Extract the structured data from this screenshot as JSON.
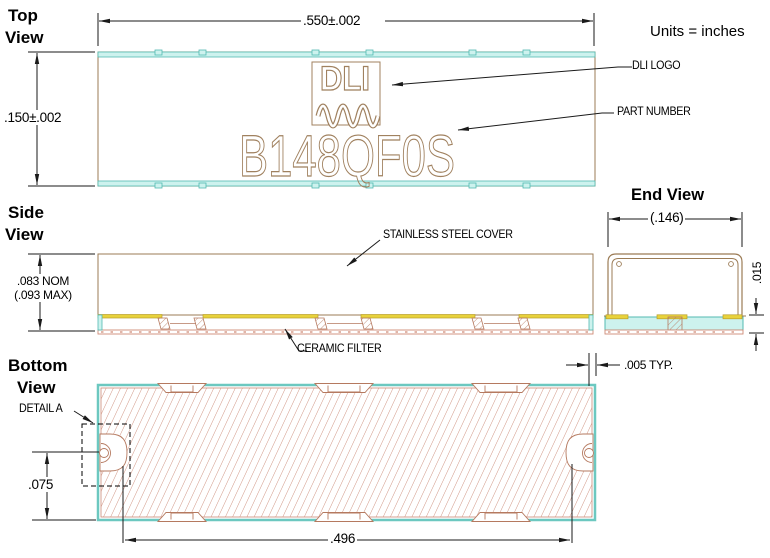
{
  "note": {
    "units": "Units = inches"
  },
  "views": {
    "top": {
      "title1": "Top",
      "title2": "View"
    },
    "side": {
      "title1": "Side",
      "title2": "View"
    },
    "bottom": {
      "title1": "Bottom",
      "title2": "View"
    },
    "end": {
      "title": "End View"
    }
  },
  "part": {
    "number": "B148QF0S",
    "logo": "DLI"
  },
  "labels": {
    "dli_logo": "DLI LOGO",
    "part_number": "PART NUMBER",
    "cover": "STAINLESS STEEL COVER",
    "ceramic": "CERAMIC FILTER",
    "detail_a": "DETAIL A"
  },
  "dimensions": {
    "top_width": ".550±.002",
    "top_height": ".150±.002",
    "side_height_nom": ".083 NOM",
    "side_height_max": "(.093 MAX)",
    "end_width": "(.146)",
    "ceramic_thickness": ".015",
    "cover_overhang": ".005 TYP.",
    "castellation_offset": ".075",
    "terminal_span": ".496"
  },
  "colors": {
    "outline_brown": "#9b7b55",
    "ceramic_salmon": "#cf8b76",
    "hatch_salmon": "#cc8b78",
    "metal_cyan_fill": "#cdf2ee",
    "metal_cyan_border": "#53b9b1",
    "solder_yellow": "#e8d23c",
    "logo_brown": "#a0815f",
    "dimension_black": "#000000"
  }
}
